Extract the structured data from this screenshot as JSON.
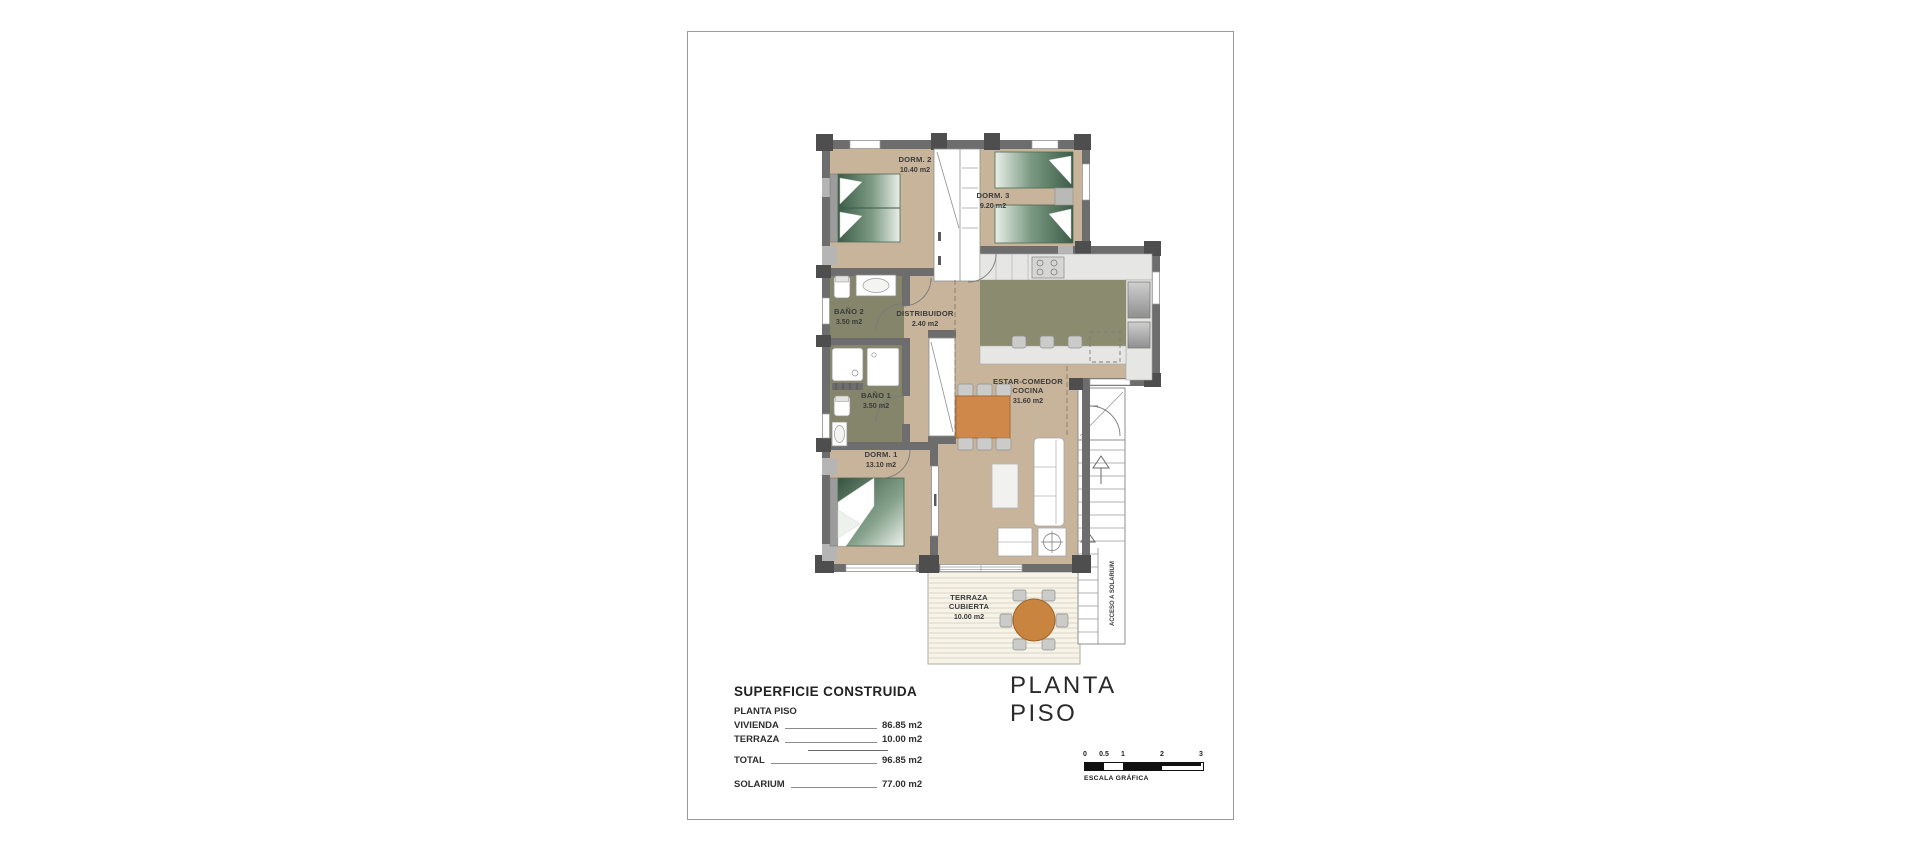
{
  "title": "PLANTA PISO",
  "plan": {
    "rooms": [
      {
        "id": "dorm2",
        "label": "DORM. 2",
        "area": "10.40 m2"
      },
      {
        "id": "dorm3",
        "label": "DORM. 3",
        "area": "9.20 m2"
      },
      {
        "id": "bano2",
        "label": "BAÑO 2",
        "area": "3.50 m2"
      },
      {
        "id": "distribuidor",
        "label": "DISTRIBUIDOR",
        "area": "2.40 m2"
      },
      {
        "id": "bano1",
        "label": "BAÑO 1",
        "area": "3.50 m2"
      },
      {
        "id": "dorm1",
        "label": "DORM. 1",
        "area": "13.10 m2"
      },
      {
        "id": "estar",
        "label": "ESTAR-COMEDOR",
        "label2": "COCINA",
        "area": "31.60 m2"
      },
      {
        "id": "terraza",
        "label": "TERRAZA",
        "label2": "CUBIERTA",
        "area": "10.00 m2"
      }
    ],
    "stairs_label": "ACCESO A SOLARIUM"
  },
  "summary": {
    "heading": "SUPERFICIE CONSTRUIDA",
    "subheading": "PLANTA PISO",
    "rows": [
      {
        "label": "VIVIENDA",
        "value": "86.85 m2"
      },
      {
        "label": "TERRAZA",
        "value": "10.00 m2"
      },
      {
        "label": "TOTAL",
        "value": "96.85 m2"
      },
      {
        "label": "SOLARIUM",
        "value": "77.00 m2"
      }
    ]
  },
  "scale": {
    "ticks": [
      "0",
      "0.5",
      "1",
      "2",
      "3"
    ],
    "caption": "ESCALA GRÁFICA"
  },
  "colors": {
    "wall": "#6d6d6d",
    "floor": "#c8b49a",
    "bathroom": "#84856b",
    "kitchen_island": "#8b8c6f",
    "bed_green": "#35543f",
    "table_orange": "#d0884a",
    "scale_black": "#111111",
    "scale_white": "#ffffff"
  }
}
